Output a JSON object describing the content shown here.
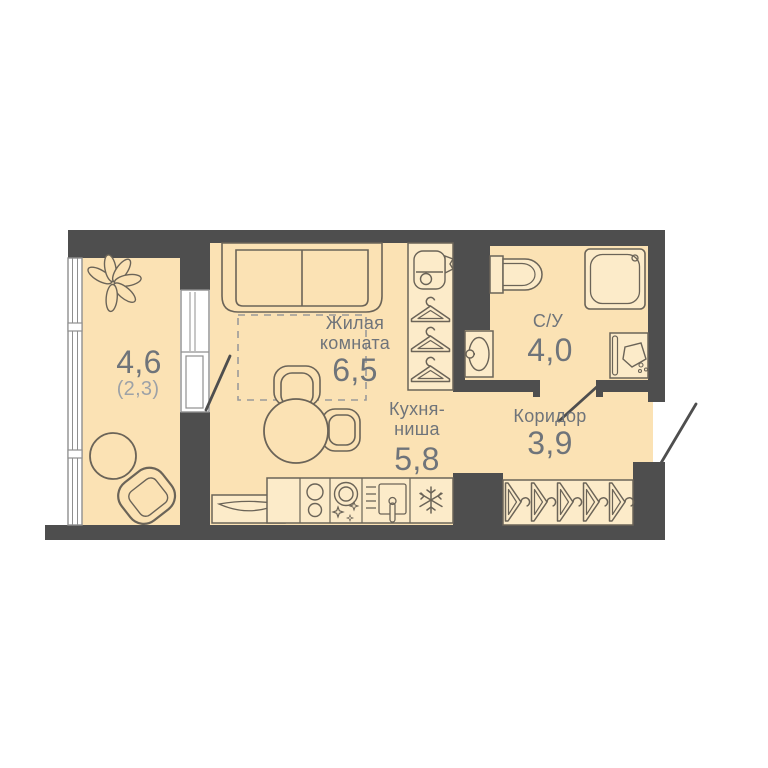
{
  "title": "Studio apartment floor plan",
  "rooms": {
    "living": {
      "label_line1": "Жилая",
      "label_line2": "комната",
      "area": "6,5"
    },
    "kitchen": {
      "label_line1": "Кухня-",
      "label_line2": "ниша",
      "area": "5,8"
    },
    "corridor": {
      "label": "Коридор",
      "area": "3,9"
    },
    "bathroom": {
      "label": "С/У",
      "area": "4,0"
    },
    "balcony": {
      "area": "4,6",
      "area_secondary": "(2,3)"
    }
  },
  "colors": {
    "wall": "#4E4E4E",
    "floor": "#FBE2B4",
    "fixture": "#FCEBC9",
    "outline": "#6B6458",
    "text": "#6F747A",
    "text_light": "#9DA2A7",
    "window_frame": "#8F8F8F",
    "dash": "#9A9A9A",
    "background": "#FFFFFF"
  },
  "icons": [
    "plant-icon",
    "sofa-icon",
    "vacuum-icon",
    "hanger-icon",
    "dining-table-icon",
    "chair-icon",
    "radiator-icon",
    "stove-icon",
    "dishwasher-icon",
    "kitchen-sink-icon",
    "snowflake-fridge-icon",
    "toilet-icon",
    "shower-icon",
    "washbasin-icon",
    "washing-machine-icon",
    "coat-hanger-icon",
    "door-swing-icon",
    "window-glazing-icon",
    "balcony-table-icon",
    "balcony-chair-icon"
  ]
}
